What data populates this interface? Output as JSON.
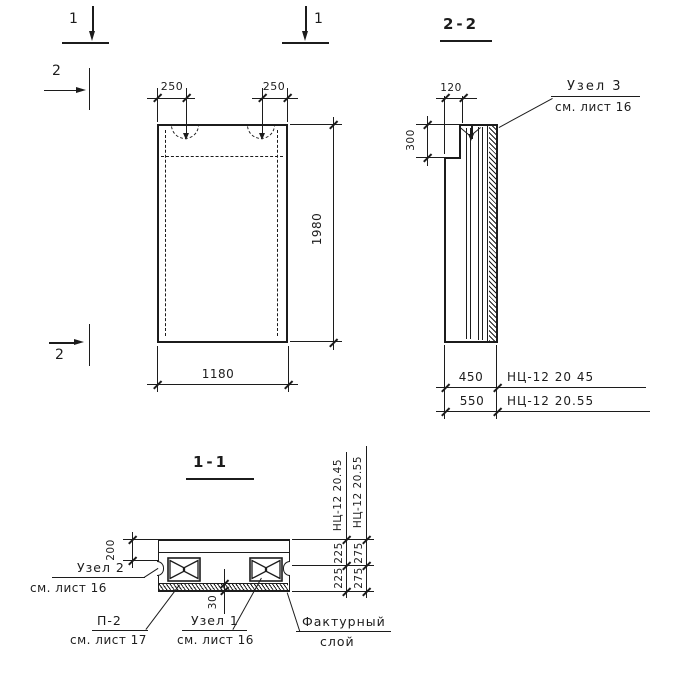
{
  "colors": {
    "ink": "#1c1c1c",
    "paper": "#ffffff"
  },
  "markers": {
    "m1_left": "1",
    "m1_right": "1",
    "m2_top": "2",
    "m2_bottom": "2"
  },
  "front_view": {
    "dim_loop_left": "250",
    "dim_loop_right": "250",
    "dim_height": "1980",
    "dim_width": "1180"
  },
  "section_2_2": {
    "title": "2-2",
    "dim_loop": "120",
    "dim_notch": "300",
    "node3": {
      "title": "Узел 3",
      "ref": "см. лист 16"
    },
    "variants": [
      {
        "width": "450",
        "mark": "НЦ-12 20 45"
      },
      {
        "width": "550",
        "mark": "НЦ-12 20.55"
      }
    ]
  },
  "section_1_1": {
    "title": "1-1",
    "dim_flange": "200",
    "dim_facing": "30",
    "variant_45": {
      "mark": "НЦ-12 20.45",
      "seg_top": "225",
      "seg_bottom": "225"
    },
    "variant_55": {
      "mark": "НЦ-12 20.55",
      "seg_top": "275",
      "seg_bottom": "275"
    },
    "node2": {
      "title": "Узел 2",
      "ref": "см. лист 16"
    },
    "p2": {
      "title": "П-2",
      "ref": "см. лист 17"
    },
    "node1": {
      "title": "Узел 1",
      "ref": "см. лист 16"
    },
    "facing": {
      "line1": "Фактурный",
      "line2": "слой"
    }
  }
}
